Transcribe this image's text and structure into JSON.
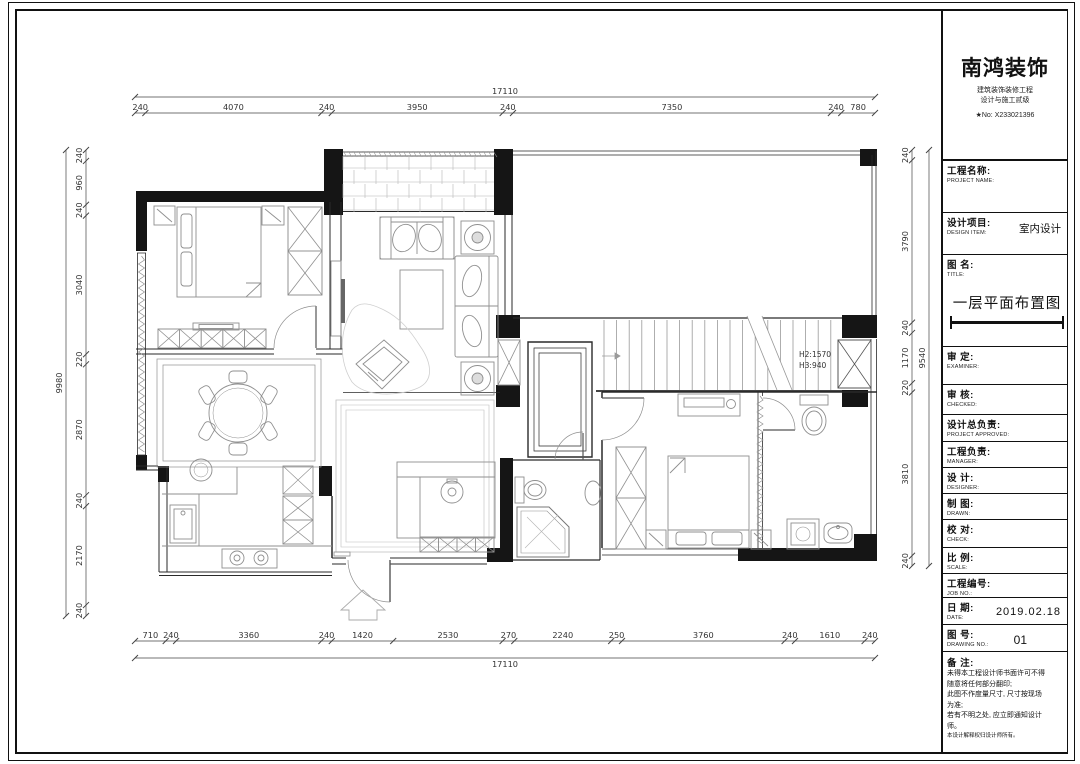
{
  "title_block": {
    "company": "南鸿装饰",
    "company_sub1": "建筑装饰装修工程",
    "company_sub2": "设计与施工贰级",
    "company_no": "★No: X233021396",
    "fields": [
      {
        "cn": "工程名称:",
        "en": "PROJECT NAME:",
        "value": ""
      },
      {
        "cn": "设计项目:",
        "en": "DESIGN ITEM:",
        "value": "室内设计"
      },
      {
        "cn": "图  名:",
        "en": "TITLE:",
        "value": "一层平面布置图"
      },
      {
        "cn": "审  定:",
        "en": "EXAMINER:",
        "value": ""
      },
      {
        "cn": "审  核:",
        "en": "CHECKED:",
        "value": ""
      },
      {
        "cn": "设计总负责:",
        "en": "PROJECT APPROVED:",
        "value": ""
      },
      {
        "cn": "工程负责:",
        "en": "MANAGER:",
        "value": ""
      },
      {
        "cn": "设  计:",
        "en": "DESIGNER:",
        "value": ""
      },
      {
        "cn": "制  图:",
        "en": "DRAWN:",
        "value": ""
      },
      {
        "cn": "校  对:",
        "en": "CHECK:",
        "value": ""
      },
      {
        "cn": "比  例:",
        "en": "SCALE:",
        "value": ""
      },
      {
        "cn": "工程编号:",
        "en": "JOB NO.:",
        "value": ""
      },
      {
        "cn": "日  期:",
        "en": "DATE:",
        "value": "2019.02.18"
      },
      {
        "cn": "图  号:",
        "en": "DRAWING NO.:",
        "value": "01"
      }
    ],
    "notes_label": "备  注:",
    "notes": [
      "未得本工程设计师书面许可不得",
      "随意将任何部分翻印;",
      "此图不作度量尺寸, 尺寸按现场",
      "为准;",
      "若有不明之处, 应立即通知设计",
      "师。",
      "本设计解释权归设计师所有。"
    ]
  },
  "dimensions": {
    "top": {
      "total": "17110",
      "segments": [
        "240",
        "4070",
        "240",
        "3950",
        "240",
        "7350",
        "240",
        "780"
      ]
    },
    "bottom": {
      "total": "17110",
      "segments": [
        "710",
        "240",
        "3360",
        "240",
        "1420",
        "2530",
        "270",
        "2240",
        "250",
        "3760",
        "240",
        "1610",
        "240"
      ]
    },
    "left": {
      "total": "9980",
      "segments": [
        "240",
        "960",
        "240",
        "3040",
        "220",
        "2870",
        "240",
        "2170",
        "240"
      ]
    },
    "right": {
      "total": "9540",
      "segments": [
        "240",
        "3790",
        "240",
        "1170",
        "220",
        "3810",
        "240"
      ]
    }
  },
  "plan_annotations": {
    "stair_note_1": "H2:1570",
    "stair_note_2": "H3:940"
  }
}
